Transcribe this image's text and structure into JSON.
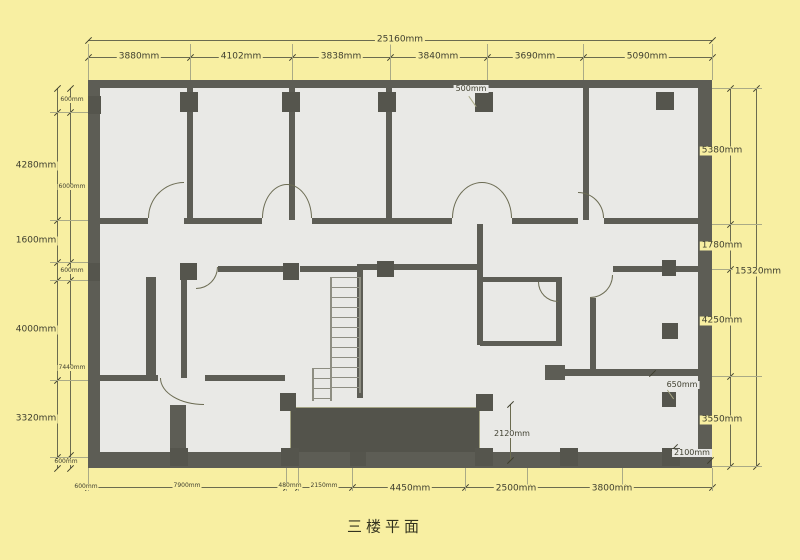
{
  "title": "三楼平面",
  "colors": {
    "background": "#f8efa2",
    "floor": "#e9e9e6",
    "wall": "#5d5d55",
    "dimension_line": "#6b6b4f",
    "dimension_text": "#3f3f2f"
  },
  "dimensions": {
    "top": [
      {
        "text": "25160mm",
        "x": 400,
        "y": 40,
        "size": "md"
      },
      {
        "text": "3880mm",
        "x": 139,
        "y": 57,
        "size": "md"
      },
      {
        "text": "4102mm",
        "x": 241,
        "y": 57,
        "size": "md"
      },
      {
        "text": "3838mm",
        "x": 341,
        "y": 57,
        "size": "md"
      },
      {
        "text": "3840mm",
        "x": 438,
        "y": 57,
        "size": "md"
      },
      {
        "text": "3690mm",
        "x": 535,
        "y": 57,
        "size": "md"
      },
      {
        "text": "5090mm",
        "x": 647,
        "y": 57,
        "size": "md"
      }
    ],
    "left": [
      {
        "text": "600mm",
        "x": 72,
        "y": 100,
        "size": "xs"
      },
      {
        "text": "4280mm",
        "x": 36,
        "y": 166,
        "size": "md"
      },
      {
        "text": "6000mm",
        "x": 72,
        "y": 187,
        "size": "xs"
      },
      {
        "text": "1600mm",
        "x": 36,
        "y": 241,
        "size": "md"
      },
      {
        "text": "600mm",
        "x": 72,
        "y": 271,
        "size": "xs"
      },
      {
        "text": "4000mm",
        "x": 36,
        "y": 330,
        "size": "md"
      },
      {
        "text": "7440mm",
        "x": 72,
        "y": 368,
        "size": "xs"
      },
      {
        "text": "3320mm",
        "x": 36,
        "y": 419,
        "size": "md"
      },
      {
        "text": "600mm",
        "x": 66,
        "y": 462,
        "size": "xs"
      },
      {
        "text": "600mm",
        "x": 86,
        "y": 487,
        "size": "xs"
      }
    ],
    "right": [
      {
        "text": "5380mm",
        "x": 722,
        "y": 151,
        "size": "md"
      },
      {
        "text": "1780mm",
        "x": 722,
        "y": 246,
        "size": "md"
      },
      {
        "text": "15320mm",
        "x": 758,
        "y": 272,
        "size": "md"
      },
      {
        "text": "4250mm",
        "x": 722,
        "y": 321,
        "size": "md"
      },
      {
        "text": "3550mm",
        "x": 722,
        "y": 420,
        "size": "md"
      }
    ],
    "bottom": [
      {
        "text": "7900mm",
        "x": 187,
        "y": 486,
        "size": "xs"
      },
      {
        "text": "480mm",
        "x": 290,
        "y": 486,
        "size": "xs"
      },
      {
        "text": "2150mm",
        "x": 324,
        "y": 486,
        "size": "xs"
      },
      {
        "text": "4450mm",
        "x": 410,
        "y": 489,
        "size": "md"
      },
      {
        "text": "2500mm",
        "x": 516,
        "y": 489,
        "size": "md"
      },
      {
        "text": "3800mm",
        "x": 612,
        "y": 489,
        "size": "md"
      }
    ],
    "interior": [
      {
        "text": "500mm",
        "x": 471,
        "y": 89,
        "size": "sm"
      },
      {
        "text": "2120mm",
        "x": 512,
        "y": 434,
        "size": "sm"
      },
      {
        "text": "650mm",
        "x": 682,
        "y": 385,
        "size": "sm"
      },
      {
        "text": "2100mm",
        "x": 692,
        "y": 453,
        "size": "sm"
      }
    ]
  },
  "plan": {
    "walls": [
      [
        88,
        80,
        624,
        8
      ],
      [
        88,
        452,
        624,
        16
      ],
      [
        88,
        80,
        12,
        388
      ],
      [
        698,
        80,
        14,
        388
      ],
      [
        187,
        88,
        6,
        132
      ],
      [
        289,
        88,
        6,
        132
      ],
      [
        386,
        88,
        6,
        132
      ],
      [
        583,
        88,
        6,
        132
      ],
      [
        100,
        218,
        48,
        6
      ],
      [
        184,
        218,
        78,
        6
      ],
      [
        312,
        218,
        140,
        6
      ],
      [
        512,
        218,
        66,
        6
      ],
      [
        604,
        218,
        94,
        6
      ],
      [
        218,
        266,
        65,
        6
      ],
      [
        300,
        266,
        58,
        6
      ],
      [
        358,
        264,
        119,
        6
      ],
      [
        613,
        266,
        85,
        6
      ],
      [
        357,
        264,
        6,
        134
      ],
      [
        477,
        224,
        6,
        56
      ],
      [
        477,
        277,
        6,
        68
      ],
      [
        480,
        277,
        80,
        5
      ],
      [
        556,
        277,
        6,
        68
      ],
      [
        480,
        341,
        82,
        5
      ],
      [
        590,
        298,
        6,
        75
      ],
      [
        558,
        369,
        140,
        7
      ],
      [
        545,
        365,
        20,
        15
      ],
      [
        146,
        277,
        10,
        101
      ],
      [
        181,
        280,
        6,
        98
      ],
      [
        100,
        375,
        58,
        6
      ],
      [
        205,
        375,
        80,
        6
      ],
      [
        170,
        405,
        16,
        47
      ]
    ],
    "columns": [
      [
        180,
        92,
        18,
        20
      ],
      [
        282,
        92,
        18,
        20
      ],
      [
        378,
        92,
        18,
        20
      ],
      [
        475,
        92,
        18,
        20
      ],
      [
        656,
        92,
        18,
        18
      ],
      [
        88,
        96,
        13,
        18
      ],
      [
        88,
        263,
        12,
        18
      ],
      [
        180,
        263,
        17,
        17
      ],
      [
        283,
        263,
        16,
        17
      ],
      [
        377,
        261,
        17,
        16
      ],
      [
        662,
        260,
        14,
        16
      ],
      [
        280,
        393,
        16,
        18
      ],
      [
        476,
        394,
        17,
        17
      ],
      [
        662,
        323,
        16,
        16
      ],
      [
        662,
        392,
        14,
        15
      ],
      [
        170,
        448,
        18,
        18
      ],
      [
        281,
        448,
        18,
        18
      ],
      [
        350,
        452,
        16,
        14
      ],
      [
        475,
        448,
        18,
        18
      ],
      [
        560,
        448,
        18,
        18
      ],
      [
        662,
        448,
        18,
        18
      ]
    ],
    "doors": [
      {
        "x": 148,
        "y": 182,
        "w": 36,
        "h": 36,
        "c": "tl"
      },
      {
        "x": 262,
        "y": 184,
        "w": 25,
        "h": 34,
        "c": "tl"
      },
      {
        "x": 287,
        "y": 184,
        "w": 25,
        "h": 34,
        "c": "tr"
      },
      {
        "x": 452,
        "y": 182,
        "w": 30,
        "h": 36,
        "c": "tl"
      },
      {
        "x": 482,
        "y": 182,
        "w": 30,
        "h": 36,
        "c": "tr"
      },
      {
        "x": 578,
        "y": 192,
        "w": 26,
        "h": 26,
        "c": "tr"
      },
      {
        "x": 196,
        "y": 267,
        "w": 22,
        "h": 22,
        "c": "br"
      },
      {
        "x": 590,
        "y": 275,
        "w": 23,
        "h": 23,
        "c": "br"
      },
      {
        "x": 538,
        "y": 282,
        "w": 20,
        "h": 20,
        "c": "bl"
      },
      {
        "x": 160,
        "y": 378,
        "w": 44,
        "h": 27,
        "c": "bl"
      }
    ],
    "stairs": [
      {
        "x": 330,
        "y": 277,
        "w": 27,
        "h": 116
      },
      {
        "x": 312,
        "y": 368,
        "w": 16,
        "h": 33
      }
    ],
    "shaft": [
      290,
      407,
      190,
      53
    ],
    "dim_lines": {
      "h": [
        {
          "x": 88,
          "y": 40,
          "w": 624,
          "ticks": [
            88,
            712
          ]
        },
        {
          "x": 88,
          "y": 57,
          "w": 624,
          "ticks": [
            88,
            190,
            292,
            390,
            487,
            583,
            712
          ]
        },
        {
          "x": 88,
          "y": 487,
          "w": 624,
          "ticks": [
            88,
            286,
            298,
            352,
            465,
            527,
            622,
            712
          ]
        }
      ],
      "v": [
        {
          "x": 57,
          "y": 88,
          "h": 380,
          "ticks": [
            88,
            112,
            220,
            262,
            280,
            380,
            457,
            468
          ]
        },
        {
          "x": 70,
          "y": 88,
          "h": 380,
          "ticks": [
            88,
            112,
            262,
            280,
            455,
            468
          ]
        },
        {
          "x": 730,
          "y": 88,
          "h": 378,
          "ticks": [
            88,
            224,
            269,
            376,
            466
          ]
        },
        {
          "x": 756,
          "y": 88,
          "h": 378,
          "ticks": [
            88,
            466
          ]
        }
      ]
    },
    "witness": {
      "top": {
        "y1": 44,
        "y2": 80,
        "xs": [
          88,
          190,
          292,
          390,
          487,
          583,
          712
        ]
      },
      "left": {
        "x1": 50,
        "x2": 88,
        "ys": [
          112,
          220,
          262,
          280,
          380,
          457
        ]
      },
      "right": {
        "x1": 712,
        "x2": 762,
        "ys": [
          88,
          224,
          269,
          376,
          466
        ]
      },
      "bottom": {
        "y1": 468,
        "y2": 491,
        "xs": [
          88,
          286,
          298,
          352,
          465,
          527,
          622,
          712
        ]
      }
    },
    "interior_marks": [
      {
        "type": "vline",
        "x": 510,
        "y1": 404,
        "y2": 460
      },
      {
        "type": "slash",
        "x": 510,
        "y": 404
      },
      {
        "type": "slash",
        "x": 510,
        "y": 460
      },
      {
        "type": "slash",
        "x": 674,
        "y": 447
      },
      {
        "type": "slash",
        "x": 710,
        "y": 460
      },
      {
        "type": "slash",
        "x": 652,
        "y": 373
      },
      {
        "type": "leader",
        "x": 472,
        "y": 95,
        "len": 13,
        "rot": -35
      },
      {
        "type": "leader",
        "x": 670,
        "y": 389,
        "len": 11,
        "rot": -35
      }
    ]
  }
}
